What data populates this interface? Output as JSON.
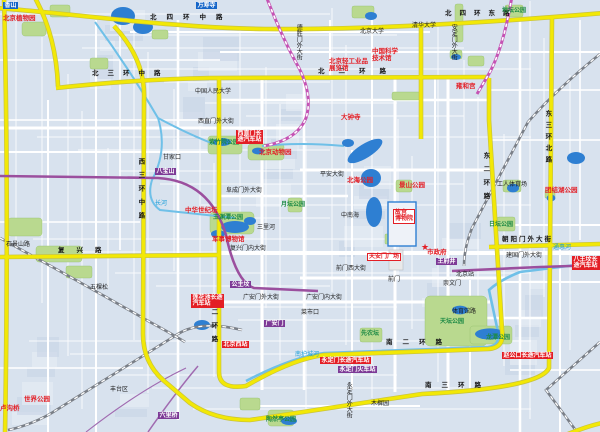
{
  "map": {
    "region_name": "北京市区",
    "colors": {
      "background": "#d8e2ee",
      "block_light": "#e6ecf5",
      "block_dark": "#c9d5e6",
      "street_white": "#ffffff",
      "ring_road_yellow": "#f2e806",
      "water_blue": "#2e7fd2",
      "river_cyan": "#6fc0e8",
      "park_green": "#b9d98f",
      "railway_gray": "#7a7f87",
      "metro_purple": "#9b4f9e",
      "lightrail_magenta": "#c553b4",
      "landmark_red": "#e31e25",
      "station_badge_purple": "#7d3a96",
      "poi_badge_blue": "#1565c8"
    },
    "star_marker": {
      "meaning": "市政府所在地",
      "x": 421,
      "y": 243,
      "glyph": "★"
    },
    "labels": [
      {
        "t": "北四环中路",
        "x": 150,
        "y": 15,
        "c": "rn",
        "sp": 10
      },
      {
        "t": "北四环东路",
        "x": 445,
        "y": 11,
        "c": "rn",
        "sp": 8
      },
      {
        "t": "北三环中路",
        "x": 92,
        "y": 71,
        "c": "rn",
        "sp": 9
      },
      {
        "t": "北二环路",
        "x": 318,
        "y": 69,
        "c": "rn",
        "sp": 14
      },
      {
        "t": "西三环中路",
        "x": 136,
        "y": 158,
        "c": "rn",
        "v": 1,
        "sp": 7
      },
      {
        "t": "西二环路",
        "x": 209,
        "y": 295,
        "c": "rn",
        "v": 1,
        "sp": 7
      },
      {
        "t": "东二环路",
        "x": 481,
        "y": 152,
        "c": "rn",
        "v": 1,
        "sp": 7
      },
      {
        "t": "东三环北路",
        "x": 543,
        "y": 110,
        "c": "rn",
        "v": 1,
        "sp": 5
      },
      {
        "t": "南二环路",
        "x": 386,
        "y": 340,
        "c": "rn",
        "sp": 10
      },
      {
        "t": "南三环路",
        "x": 425,
        "y": 383,
        "c": "rn",
        "sp": 10
      },
      {
        "t": "复兴路",
        "x": 58,
        "y": 248,
        "c": "rn",
        "sp": 12
      },
      {
        "t": "朝阳门外大街",
        "x": 502,
        "y": 237,
        "c": "rn",
        "sp": 2
      },
      {
        "t": "西直门外大街",
        "x": 198,
        "y": 119,
        "c": "st"
      },
      {
        "t": "阜成门外大街",
        "x": 226,
        "y": 188,
        "c": "st"
      },
      {
        "t": "平安大街",
        "x": 320,
        "y": 172,
        "c": "st"
      },
      {
        "t": "复兴门内大街",
        "x": 230,
        "y": 246,
        "c": "st"
      },
      {
        "t": "前门西大街",
        "x": 336,
        "y": 266,
        "c": "st"
      },
      {
        "t": "建国门外大街",
        "x": 506,
        "y": 253,
        "c": "st"
      },
      {
        "t": "广安门外大街",
        "x": 243,
        "y": 295,
        "c": "st"
      },
      {
        "t": "广安门内大街",
        "x": 306,
        "y": 295,
        "c": "st"
      },
      {
        "t": "体育馆路",
        "x": 452,
        "y": 309,
        "c": "st"
      },
      {
        "t": "石景山路",
        "x": 6,
        "y": 242,
        "c": "st"
      },
      {
        "t": "德胜门外大街",
        "x": 295,
        "y": 24,
        "c": "st",
        "v": 1
      },
      {
        "t": "安定门外大街",
        "x": 450,
        "y": 24,
        "c": "st",
        "v": 1
      },
      {
        "t": "永定门外大街",
        "x": 345,
        "y": 382,
        "c": "st",
        "v": 1
      },
      {
        "t": "工人体育场",
        "x": 497,
        "y": 182,
        "c": "st"
      },
      {
        "t": "北京大学",
        "x": 360,
        "y": 29,
        "c": "st"
      },
      {
        "t": "清华大学",
        "x": 412,
        "y": 23,
        "c": "st"
      },
      {
        "t": "中国人民大学",
        "x": 195,
        "y": 89,
        "c": "st"
      },
      {
        "t": "北京站",
        "x": 456,
        "y": 272,
        "c": "st"
      },
      {
        "t": "前门",
        "x": 388,
        "y": 277,
        "c": "st"
      },
      {
        "t": "中南海",
        "x": 341,
        "y": 213,
        "c": "st"
      },
      {
        "t": "三里河",
        "x": 257,
        "y": 225,
        "c": "st"
      },
      {
        "t": "甘家口",
        "x": 163,
        "y": 155,
        "c": "st"
      },
      {
        "t": "菜市口",
        "x": 301,
        "y": 310,
        "c": "st"
      },
      {
        "t": "崇文门",
        "x": 443,
        "y": 281,
        "c": "st"
      },
      {
        "t": "五棵松",
        "x": 90,
        "y": 285,
        "c": "st"
      },
      {
        "t": "丰台区",
        "x": 110,
        "y": 387,
        "c": "st"
      },
      {
        "t": "木樨园",
        "x": 371,
        "y": 401,
        "c": "st"
      },
      {
        "t": "北京植物园",
        "x": 3,
        "y": 16,
        "c": "rd"
      },
      {
        "t": "北京动物园",
        "x": 259,
        "y": 150,
        "c": "rd"
      },
      {
        "t": "大钟寺",
        "x": 341,
        "y": 115,
        "c": "rd"
      },
      {
        "t": "北京轻工业品\n展览馆",
        "x": 329,
        "y": 59,
        "c": "rd"
      },
      {
        "t": "中国科学\n技术馆",
        "x": 372,
        "y": 49,
        "c": "rd"
      },
      {
        "t": "中华世纪坛",
        "x": 185,
        "y": 208,
        "c": "rd"
      },
      {
        "t": "军事博物馆",
        "x": 212,
        "y": 237,
        "c": "rd"
      },
      {
        "t": "北海公园",
        "x": 347,
        "y": 178,
        "c": "rd"
      },
      {
        "t": "景山公园",
        "x": 399,
        "y": 183,
        "c": "rd"
      },
      {
        "t": "故宫\n博物院",
        "x": 393,
        "y": 209,
        "c": "ch"
      },
      {
        "t": "天安门广场",
        "x": 367,
        "y": 253,
        "c": "ch"
      },
      {
        "t": "市政府",
        "x": 427,
        "y": 250,
        "c": "rd"
      },
      {
        "t": "团结湖公园",
        "x": 545,
        "y": 188,
        "c": "rd"
      },
      {
        "t": "雍和宫",
        "x": 456,
        "y": 84,
        "c": "rd"
      },
      {
        "t": "世界公园",
        "x": 24,
        "y": 397,
        "c": "rd"
      },
      {
        "t": "卢沟桥",
        "x": 0,
        "y": 406,
        "c": "rd"
      },
      {
        "t": "紫竹院公园",
        "x": 209,
        "y": 140,
        "c": "gn"
      },
      {
        "t": "玉渊潭公园",
        "x": 213,
        "y": 215,
        "c": "gn"
      },
      {
        "t": "天坛公园",
        "x": 440,
        "y": 319,
        "c": "gn"
      },
      {
        "t": "陶然亭公园",
        "x": 266,
        "y": 417,
        "c": "gn"
      },
      {
        "t": "日坛公园",
        "x": 489,
        "y": 222,
        "c": "gn"
      },
      {
        "t": "地坛公园",
        "x": 502,
        "y": 8,
        "c": "gn"
      },
      {
        "t": "龙潭公园",
        "x": 486,
        "y": 335,
        "c": "gn"
      },
      {
        "t": "月坛公园",
        "x": 281,
        "y": 202,
        "c": "gn"
      },
      {
        "t": "先农坛",
        "x": 361,
        "y": 331,
        "c": "gn"
      },
      {
        "t": "长河",
        "x": 155,
        "y": 201,
        "c": "wa"
      },
      {
        "t": "通惠河",
        "x": 553,
        "y": 245,
        "c": "wa"
      },
      {
        "t": "南护城河",
        "x": 295,
        "y": 352,
        "c": "wa"
      },
      {
        "t": "西直门长\n途汽车站",
        "x": 236,
        "y": 130,
        "c": "br"
      },
      {
        "t": "北京西站",
        "x": 222,
        "y": 341,
        "c": "br"
      },
      {
        "t": "莲花池长途\n汽车站",
        "x": 191,
        "y": 294,
        "c": "br"
      },
      {
        "t": "永定门长途汽车站",
        "x": 320,
        "y": 357,
        "c": "br"
      },
      {
        "t": "赵公口长途汽车站",
        "x": 502,
        "y": 352,
        "c": "br"
      },
      {
        "t": "八王坟长途汽车站",
        "x": 572,
        "y": 256,
        "c": "br"
      },
      {
        "t": "八宝山",
        "x": 155,
        "y": 168,
        "c": "bp"
      },
      {
        "t": "公主坟",
        "x": 230,
        "y": 281,
        "c": "bp"
      },
      {
        "t": "王府井",
        "x": 436,
        "y": 258,
        "c": "bp"
      },
      {
        "t": "广安门",
        "x": 264,
        "y": 320,
        "c": "bp"
      },
      {
        "t": "永定门火车站",
        "x": 338,
        "y": 366,
        "c": "bp"
      },
      {
        "t": "六里桥",
        "x": 158,
        "y": 412,
        "c": "bp"
      },
      {
        "t": "香山",
        "x": 3,
        "y": 2,
        "c": "bb"
      },
      {
        "t": "万寿寺",
        "x": 196,
        "y": 2,
        "c": "bb"
      }
    ]
  }
}
